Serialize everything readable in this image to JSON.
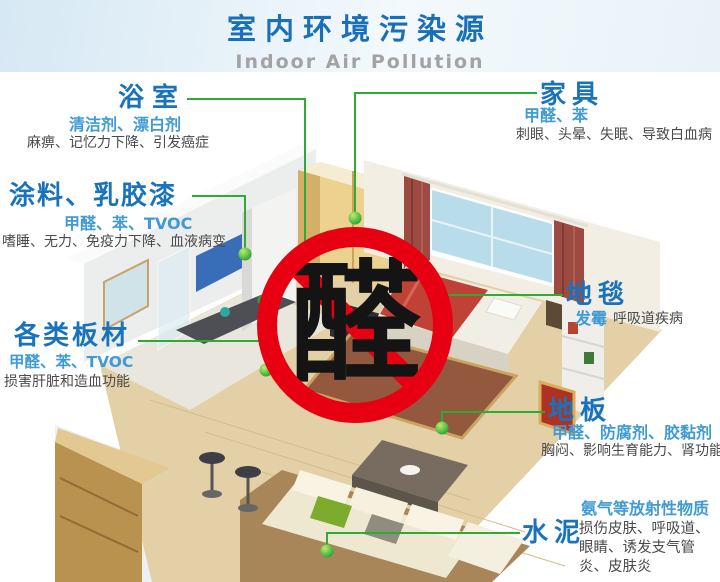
{
  "header": {
    "title": "室内环境污染源",
    "subtitle": "Indoor Air Pollution"
  },
  "center_sign": {
    "character": "醛"
  },
  "labels": [
    {
      "id": "bathroom",
      "title": "浴室",
      "pollutants": "清洁剂、漂白剂",
      "effects": "麻痹、记忆力下降、引发癌症"
    },
    {
      "id": "paint",
      "title": "涂料、乳胶漆",
      "pollutants": "甲醛、苯、TVOC",
      "effects": "嗜睡、无力、免疫力下降、血液病变"
    },
    {
      "id": "boards",
      "title": "各类板材",
      "pollutants": "甲醛、苯、TVOC",
      "effects": "损害肝脏和造血功能"
    },
    {
      "id": "furniture",
      "title": "家具",
      "pollutants": "甲醛、苯",
      "effects": "刺眼、头晕、失眠、导致白血病"
    },
    {
      "id": "carpet",
      "title": "地毯",
      "pollutants": "发霉",
      "effects": "呼吸道疾病"
    },
    {
      "id": "floor",
      "title": "地板",
      "pollutants": "甲醛、防腐剂、胶黏剂",
      "effects": "胸闷、影响生育能力、肾功能"
    },
    {
      "id": "cement",
      "title": "水泥",
      "pollutants": "氨气等放射性物质",
      "effects": "损伤皮肤、呼吸道、眼睛、诱发支气管炎、皮肤炎"
    }
  ],
  "colors": {
    "title_blue": "#1a70b8",
    "subtitle_gray": "#a3a3a3",
    "label_blue": "#1973bc",
    "pollutant_blue": "#3f9ad5",
    "effect_gray": "#4a4a4a",
    "line_green": "#2faa37",
    "sign_red": "#e60012",
    "char_black": "#141414"
  }
}
